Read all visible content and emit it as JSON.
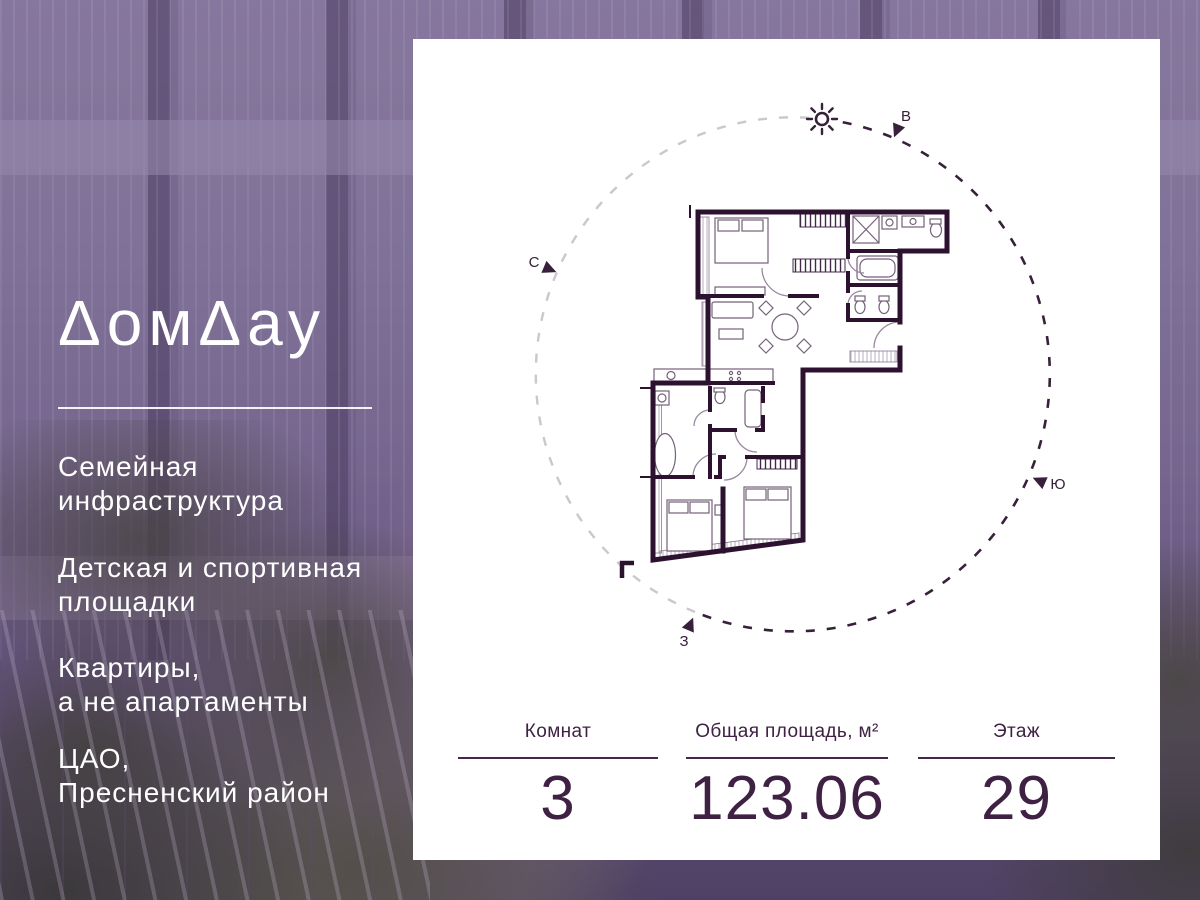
{
  "brand": {
    "name": "ДомДау",
    "logo_display": "ΔомΔау"
  },
  "features": [
    {
      "line1": "Семейная",
      "line2": "инфраструктура"
    },
    {
      "line1": "Детская и спортивная",
      "line2": "площадки"
    },
    {
      "line1": "Квартиры,",
      "line2": "а не апартаменты"
    },
    {
      "line1": "ЦАО,",
      "line2": "Пресненский район"
    }
  ],
  "card": {
    "stats": [
      {
        "label": "Комнат",
        "value": "3"
      },
      {
        "label": "Общая площадь, м²",
        "value": "123.06"
      },
      {
        "label": "Этаж",
        "value": "29"
      }
    ]
  },
  "compass": {
    "north": "С",
    "east": "В",
    "south": "Ю",
    "west": "З",
    "sun_icon": "sun-icon"
  },
  "colors": {
    "accent_text": "#3f2144",
    "plan_wall": "#2d1230",
    "arc_dark": "#372039",
    "arc_light": "#cbc6cf",
    "card_bg": "#ffffff",
    "overlay_tint": "#745c8a"
  }
}
